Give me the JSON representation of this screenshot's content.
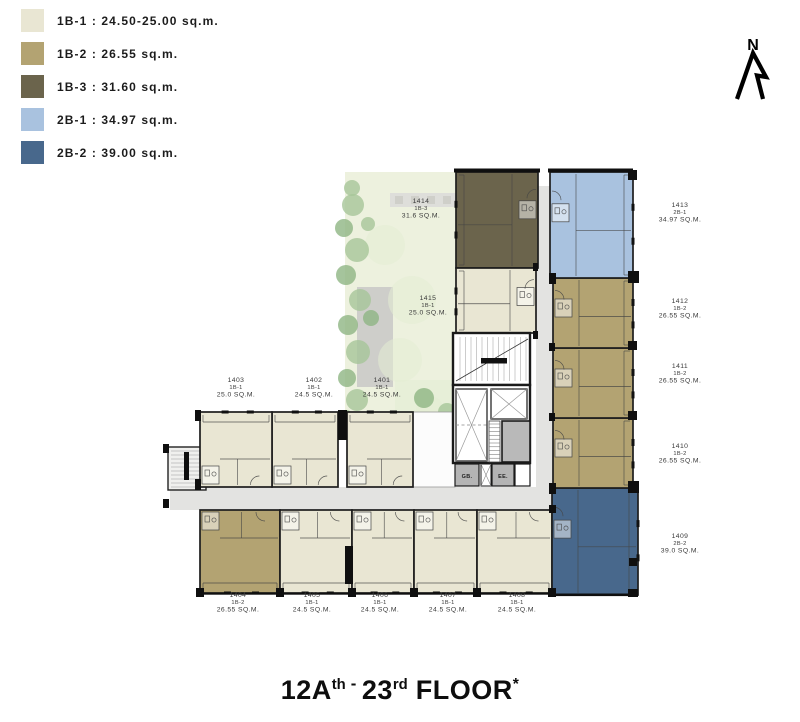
{
  "legend": {
    "items": [
      {
        "code": "1B-1",
        "text": "1B-1 : 24.50-25.00 sq.m.",
        "color": "#e9e6d3"
      },
      {
        "code": "1B-2",
        "text": "1B-2 : 26.55 sq.m.",
        "color": "#b3a372"
      },
      {
        "code": "1B-3",
        "text": "1B-3 : 31.60 sq.m.",
        "color": "#6b644c"
      },
      {
        "code": "2B-1",
        "text": "2B-1 : 34.97 sq.m.",
        "color": "#a9c2df"
      },
      {
        "code": "2B-2",
        "text": "2B-2 : 39.00 sq.m.",
        "color": "#48688c"
      }
    ]
  },
  "compass": {
    "label": "N"
  },
  "core_labels": {
    "gb": "GB.",
    "ee": "EE."
  },
  "floor_title": {
    "part1": "12A",
    "sup1": "th",
    "dash": "-",
    "part2": "23",
    "sup2": "rd",
    "part3": " FLOOR",
    "star": "*"
  },
  "units": [
    {
      "id": "1401",
      "type": "1B-1",
      "area": "24.5 SQ.M."
    },
    {
      "id": "1402",
      "type": "1B-1",
      "area": "24.5 SQ.M."
    },
    {
      "id": "1403",
      "type": "1B-1",
      "area": "25.0 SQ.M."
    },
    {
      "id": "1404",
      "type": "1B-2",
      "area": "26.55 SQ.M."
    },
    {
      "id": "1405",
      "type": "1B-1",
      "area": "24.5 SQ.M."
    },
    {
      "id": "1406",
      "type": "1B-1",
      "area": "24.5 SQ.M."
    },
    {
      "id": "1407",
      "type": "1B-1",
      "area": "24.5 SQ.M."
    },
    {
      "id": "1408",
      "type": "1B-1",
      "area": "24.5 SQ.M."
    },
    {
      "id": "1409",
      "type": "2B-2",
      "area": "39.0 SQ.M."
    },
    {
      "id": "1410",
      "type": "1B-2",
      "area": "26.55 SQ.M."
    },
    {
      "id": "1411",
      "type": "1B-2",
      "area": "26.55 SQ.M."
    },
    {
      "id": "1412",
      "type": "1B-2",
      "area": "26.55 SQ.M."
    },
    {
      "id": "1413",
      "type": "2B-1",
      "area": "34.97 SQ.M."
    },
    {
      "id": "1414",
      "type": "1B-3",
      "area": "31.6 SQ.M."
    },
    {
      "id": "1415",
      "type": "1B-1",
      "area": "25.0 SQ.M."
    }
  ]
}
